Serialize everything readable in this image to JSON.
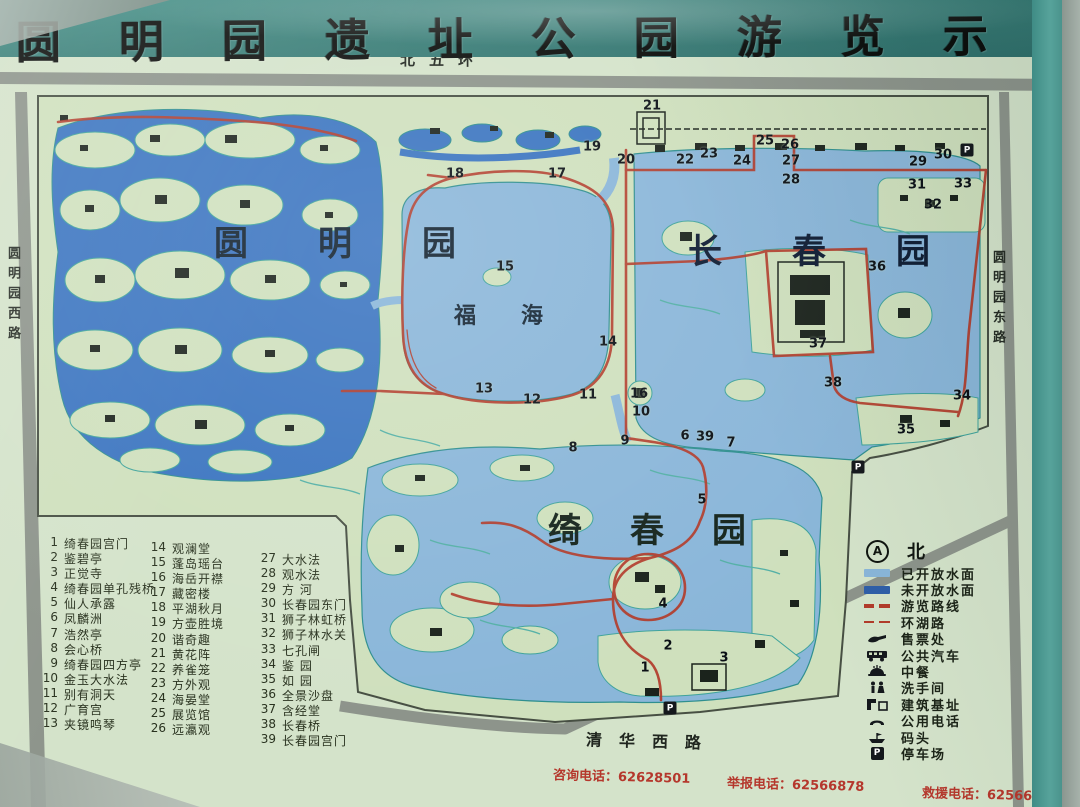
{
  "title": {
    "text": "圆明园遗址公园游览示意图"
  },
  "roads": {
    "north": "北五环",
    "west": "圆明园西路",
    "east": "圆明园东路",
    "south": "清华西路"
  },
  "garden_labels": {
    "yuanmingyuan": "圆明园",
    "changchunyuan": "长春园",
    "qichunyuan": "绮春园",
    "fuhai": "福海"
  },
  "index": {
    "col1": [
      {
        "n": "1",
        "name": "绮春园宫门"
      },
      {
        "n": "2",
        "name": "鉴碧亭"
      },
      {
        "n": "3",
        "name": "正觉寺"
      },
      {
        "n": "4",
        "name": "绮春园单孔残桥"
      },
      {
        "n": "5",
        "name": "仙人承露"
      },
      {
        "n": "6",
        "name": "凤麟洲"
      },
      {
        "n": "7",
        "name": "浩然亭"
      },
      {
        "n": "8",
        "name": "会心桥"
      },
      {
        "n": "9",
        "name": "绮春园四方亭"
      },
      {
        "n": "10",
        "name": "金玉大水法"
      },
      {
        "n": "11",
        "name": "别有洞天"
      },
      {
        "n": "12",
        "name": "广育宫"
      },
      {
        "n": "13",
        "name": "夹镜鸣琴"
      }
    ],
    "col2": [
      {
        "n": "14",
        "name": "观澜堂"
      },
      {
        "n": "15",
        "name": "蓬岛瑶台"
      },
      {
        "n": "16",
        "name": "海岳开襟"
      },
      {
        "n": "17",
        "name": "藏密楼"
      },
      {
        "n": "18",
        "name": "平湖秋月"
      },
      {
        "n": "19",
        "name": "方壶胜境"
      },
      {
        "n": "20",
        "name": "谐奇趣"
      },
      {
        "n": "21",
        "name": "黄花阵"
      },
      {
        "n": "22",
        "name": "养雀笼"
      },
      {
        "n": "23",
        "name": "方外观"
      },
      {
        "n": "24",
        "name": "海晏堂"
      },
      {
        "n": "25",
        "name": "展览馆"
      },
      {
        "n": "26",
        "name": "远瀛观"
      }
    ],
    "col3": [
      {
        "n": "27",
        "name": "大水法"
      },
      {
        "n": "28",
        "name": "观水法"
      },
      {
        "n": "29",
        "name": "方  河"
      },
      {
        "n": "30",
        "name": "长春园东门"
      },
      {
        "n": "31",
        "name": "狮子林虹桥"
      },
      {
        "n": "32",
        "name": "狮子林水关"
      },
      {
        "n": "33",
        "name": "七孔闸"
      },
      {
        "n": "34",
        "name": "鉴  园"
      },
      {
        "n": "35",
        "name": "如  园"
      },
      {
        "n": "36",
        "name": "全景沙盘"
      },
      {
        "n": "37",
        "name": "含经堂"
      },
      {
        "n": "38",
        "name": "长春桥"
      },
      {
        "n": "39",
        "name": "长春园宫门"
      }
    ]
  },
  "legend": {
    "north_label": "北",
    "north_icon_letter": "A",
    "parking_letter": "P",
    "items": [
      {
        "icon": "water-open",
        "label": "已开放水面",
        "color": "#8ab6d9"
      },
      {
        "icon": "water-closed",
        "label": "未开放水面",
        "color": "#2f5fa8"
      },
      {
        "icon": "tour-route",
        "label": "游览路线",
        "color": "#b23b2a"
      },
      {
        "icon": "lake-road",
        "label": "环湖路",
        "color": "#b23b2a"
      },
      {
        "icon": "ticket-office",
        "label": "售票处"
      },
      {
        "icon": "bus",
        "label": "公共汽车"
      },
      {
        "icon": "restaurant",
        "label": "中餐"
      },
      {
        "icon": "restroom",
        "label": "洗手间"
      },
      {
        "icon": "building-site",
        "label": "建筑基址"
      },
      {
        "icon": "telephone",
        "label": "公用电话"
      },
      {
        "icon": "dock",
        "label": "码头"
      },
      {
        "icon": "parking",
        "label": "停车场"
      }
    ]
  },
  "contacts": {
    "separator": "：",
    "items": [
      {
        "label": "咨询电话",
        "number": "62628501"
      },
      {
        "label": "举报电话",
        "number": "62566878"
      },
      {
        "label": "救援电话",
        "number": "62566879"
      }
    ]
  },
  "map": {
    "colors": {
      "water_open": "#8ab6d9",
      "water_closed": "#3a74c0",
      "route": "#b23b2a",
      "land": "#cfe0bd",
      "road": "#8d948b"
    },
    "markers": [
      {
        "n": "1",
        "x": 645,
        "y": 668
      },
      {
        "n": "2",
        "x": 668,
        "y": 646
      },
      {
        "n": "3",
        "x": 724,
        "y": 658
      },
      {
        "n": "4",
        "x": 663,
        "y": 604
      },
      {
        "n": "5",
        "x": 702,
        "y": 500
      },
      {
        "n": "6",
        "x": 685,
        "y": 436
      },
      {
        "n": "7",
        "x": 731,
        "y": 443
      },
      {
        "n": "8",
        "x": 573,
        "y": 448
      },
      {
        "n": "9",
        "x": 625,
        "y": 441
      },
      {
        "n": "10",
        "x": 641,
        "y": 412
      },
      {
        "n": "11",
        "x": 588,
        "y": 395
      },
      {
        "n": "12",
        "x": 532,
        "y": 400
      },
      {
        "n": "13",
        "x": 484,
        "y": 389
      },
      {
        "n": "14",
        "x": 608,
        "y": 342
      },
      {
        "n": "15",
        "x": 505,
        "y": 267
      },
      {
        "n": "16",
        "x": 639,
        "y": 394
      },
      {
        "n": "17",
        "x": 557,
        "y": 174
      },
      {
        "n": "18",
        "x": 455,
        "y": 174
      },
      {
        "n": "19",
        "x": 592,
        "y": 147
      },
      {
        "n": "20",
        "x": 626,
        "y": 160
      },
      {
        "n": "21",
        "x": 652,
        "y": 106
      },
      {
        "n": "22",
        "x": 685,
        "y": 160
      },
      {
        "n": "23",
        "x": 709,
        "y": 154
      },
      {
        "n": "24",
        "x": 742,
        "y": 161
      },
      {
        "n": "25",
        "x": 765,
        "y": 141
      },
      {
        "n": "26",
        "x": 790,
        "y": 145
      },
      {
        "n": "27",
        "x": 791,
        "y": 161
      },
      {
        "n": "28",
        "x": 791,
        "y": 180
      },
      {
        "n": "29",
        "x": 918,
        "y": 162
      },
      {
        "n": "30",
        "x": 943,
        "y": 155
      },
      {
        "n": "31",
        "x": 917,
        "y": 185
      },
      {
        "n": "32",
        "x": 933,
        "y": 205
      },
      {
        "n": "33",
        "x": 963,
        "y": 184
      },
      {
        "n": "34",
        "x": 962,
        "y": 396
      },
      {
        "n": "35",
        "x": 906,
        "y": 430
      },
      {
        "n": "36",
        "x": 877,
        "y": 267
      },
      {
        "n": "37",
        "x": 818,
        "y": 344
      },
      {
        "n": "38",
        "x": 833,
        "y": 383
      },
      {
        "n": "39",
        "x": 705,
        "y": 437
      }
    ],
    "p_markers": [
      {
        "label": "P",
        "x": 967,
        "y": 150
      },
      {
        "label": "P",
        "x": 858,
        "y": 467
      },
      {
        "label": "P",
        "x": 670,
        "y": 708
      }
    ]
  }
}
